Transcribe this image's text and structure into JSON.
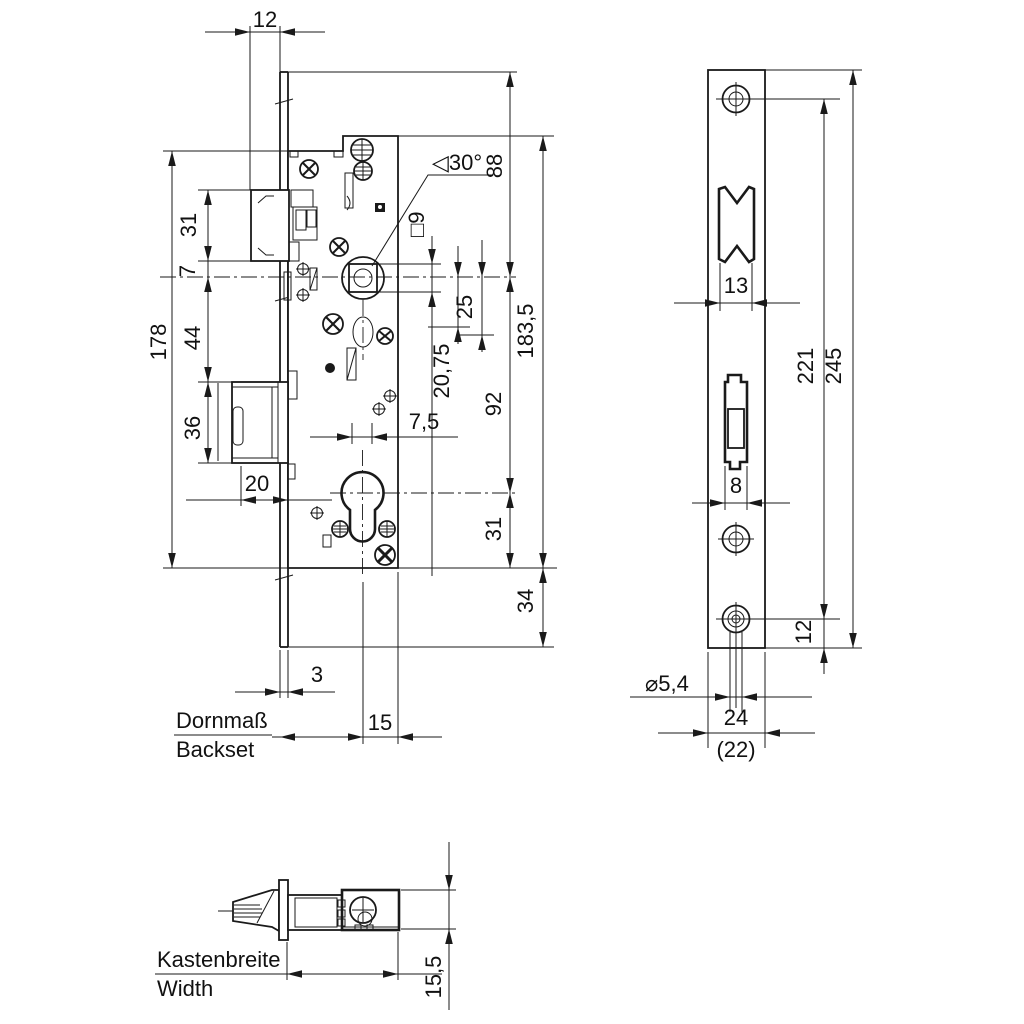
{
  "front_view": {
    "dims": {
      "top_offset": "12",
      "latch_height": "31",
      "latch_to_axis": "7",
      "case_left_height": "178",
      "axis_to_bolt": "44",
      "bolt_height": "36",
      "bolt_throw": "20",
      "faceplate_thickness": "3",
      "axis_to_back": "15",
      "faceplate_top_to_axis": "88",
      "spindle_square": "□9",
      "angle": "◁30°",
      "axis_to_pin": "20,75",
      "axis_to_oval": "25",
      "axis_to_cylinder": "92",
      "case_height": "183,5",
      "cylinder_to_bottom": "31",
      "bottom_extension": "34",
      "axis_offset": "7,5"
    },
    "labels": {
      "backset_de": "Dornmaß",
      "backset_en": "Backset"
    }
  },
  "faceplate_view": {
    "dims": {
      "latch_opening": "13",
      "bolt_opening": "8",
      "hole_distance": "221",
      "faceplate_length": "245",
      "hole_to_end": "12",
      "screw_hole_dia": "⌀5,4",
      "faceplate_width": "24",
      "faceplate_width_alt": "(22)"
    }
  },
  "side_view": {
    "labels": {
      "width_de": "Kastenbreite",
      "width_en": "Width"
    },
    "dims": {
      "case_thickness": "15,5"
    }
  }
}
